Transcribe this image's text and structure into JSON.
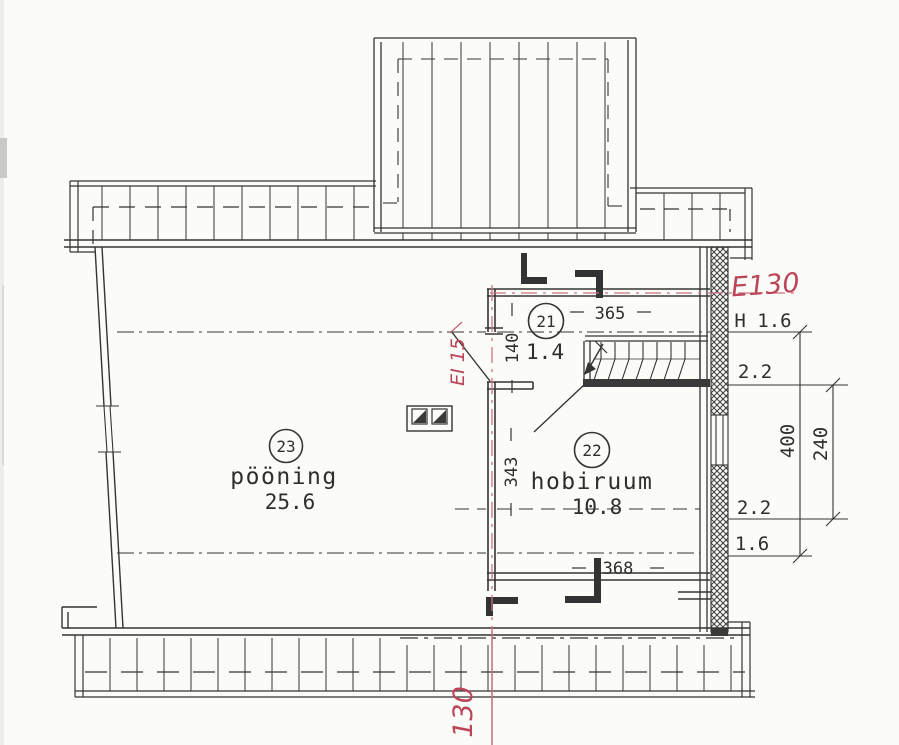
{
  "plan": {
    "room21": {
      "number": "21",
      "area": "1.4",
      "width_dim": "365",
      "height_dim": "140"
    },
    "room22": {
      "number": "22",
      "name": "hobiruum",
      "area": "10.8",
      "width_dim": "368",
      "height_dim": "343"
    },
    "room23": {
      "number": "23",
      "name": "pööning",
      "area": "25.6"
    },
    "right_dims": {
      "h_label": "H 1.6",
      "upper_22": "2.2",
      "lower_22": "2.2",
      "lower_16": "1.6",
      "outer": "400",
      "inner": "240"
    },
    "red_marks": {
      "wall_rating": "E130",
      "door_rating": "EI 15",
      "section_axis": "130"
    },
    "colors": {
      "ink": "#343434",
      "red_text": "#bb4458",
      "red_line": "#cd7383",
      "paper": "#fbfbf8"
    }
  }
}
